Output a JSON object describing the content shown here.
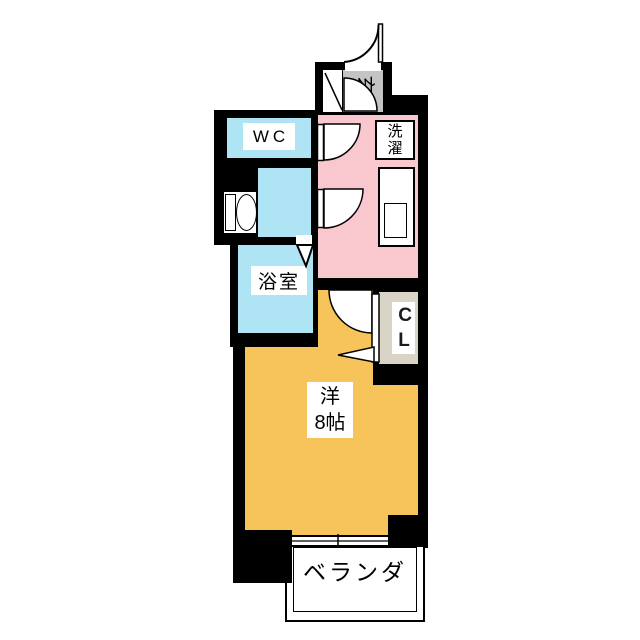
{
  "rooms": {
    "entrance": {
      "label": "玄"
    },
    "wc": {
      "label": "WC"
    },
    "laundry": {
      "label": "洗濯"
    },
    "bathroom": {
      "label": "浴室"
    },
    "closet": {
      "label": "CL"
    },
    "main_room": {
      "label_line1": "洋",
      "label_line2": "8帖"
    },
    "veranda": {
      "label": "ベランダ"
    }
  },
  "colors": {
    "wall": "#000000",
    "wet_rooms": "#aee4f3",
    "hallway_kitchen": "#f8c8ce",
    "main_room": "#f7c35b",
    "entrance_floor": "#c4c4c4",
    "closet_floor": "#d8d4c6",
    "background": "#ffffff"
  }
}
